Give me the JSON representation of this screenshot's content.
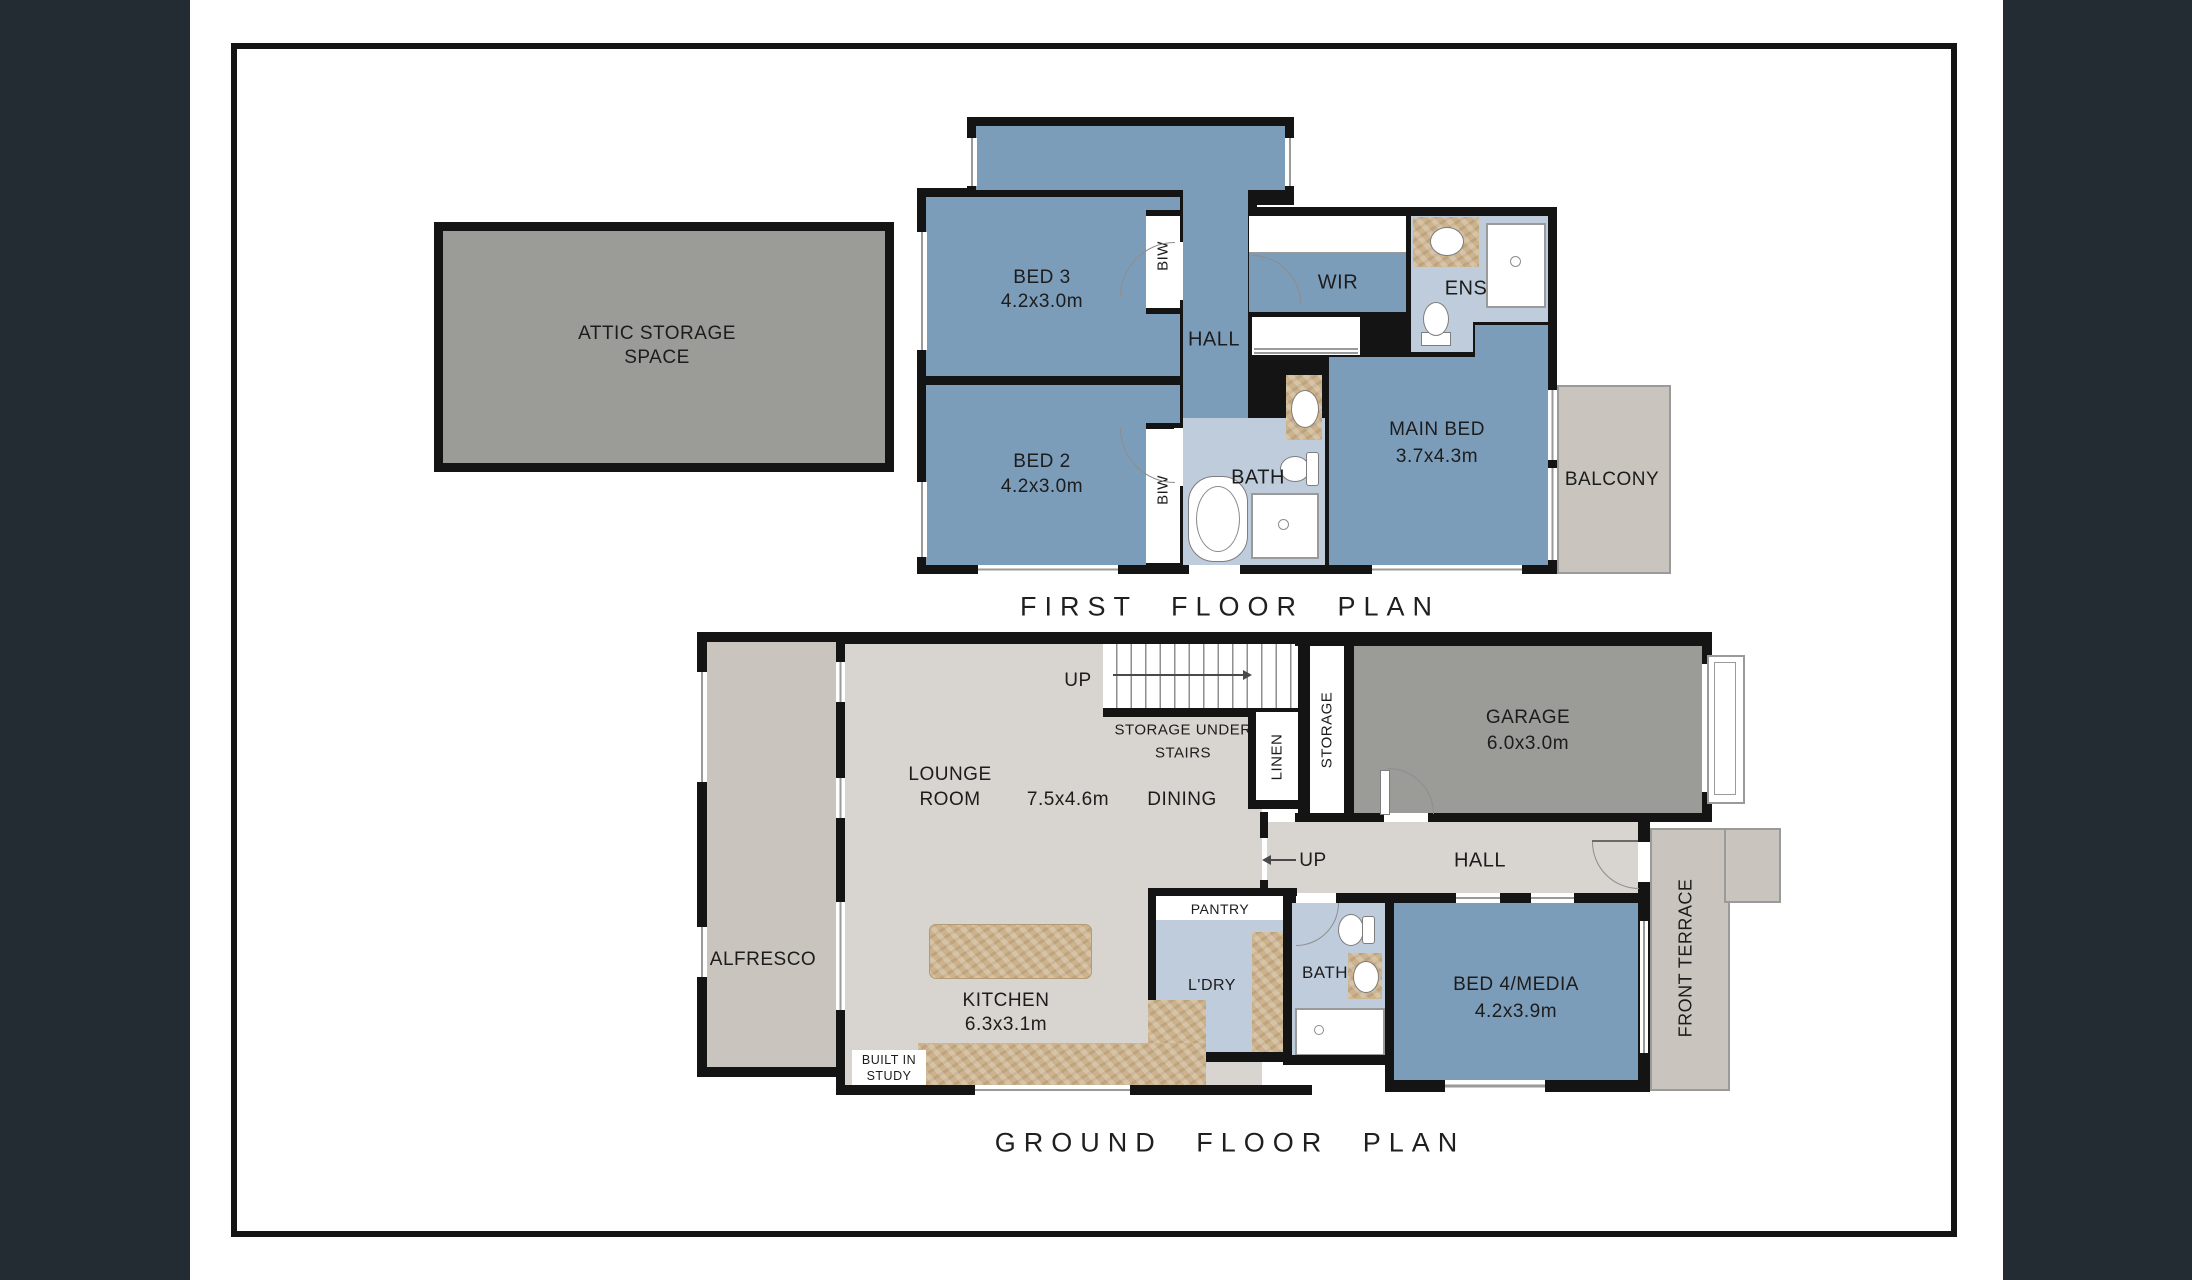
{
  "colors": {
    "page_background": "#232b33",
    "paper": "#ffffff",
    "wall": "#141414",
    "room_blue": "#7c9db9",
    "wet_area_blue": "#bfccdb",
    "floor_greige": "#d8d4cf",
    "outdoor_beige": "#c9c5be",
    "garage_gray": "#9b9b98",
    "counter_tan": "#ccb28d"
  },
  "first_floor": {
    "title": "FIRST FLOOR PLAN",
    "attic_label_line1": "ATTIC STORAGE",
    "attic_label_line2": "SPACE",
    "rooms": {
      "bed3_name": "BED 3",
      "bed3_dims": "4.2x3.0m",
      "bed2_name": "BED 2",
      "bed2_dims": "4.2x3.0m",
      "main_bed_name": "MAIN BED",
      "main_bed_dims": "3.7x4.3m",
      "hall": "HALL",
      "wir": "WIR",
      "ens": "ENS",
      "bath": "BATH",
      "balcony": "BALCONY",
      "biw": "BIW"
    }
  },
  "ground_floor": {
    "title": "GROUND FLOOR PLAN",
    "rooms": {
      "lounge_line1": "LOUNGE",
      "lounge_line2": "ROOM",
      "lounge_dims": "7.5x4.6m",
      "dining": "DINING",
      "kitchen_name": "KITCHEN",
      "kitchen_dims": "6.3x3.1m",
      "alfresco": "ALFRESCO",
      "garage_name": "GARAGE",
      "garage_dims": "6.0x3.0m",
      "hall": "HALL",
      "up_stairs": "UP",
      "up_hall": "UP",
      "storage_under_line1": "STORAGE UNDER",
      "storage_under_line2": "STAIRS",
      "linen": "LINEN",
      "storage": "STORAGE",
      "pantry": "PANTRY",
      "laundry": "L'DRY",
      "bath": "BATH",
      "bed4_name": "BED 4/MEDIA",
      "bed4_dims": "4.2x3.9m",
      "front_terrace": "FRONT TERRACE",
      "study_line1": "BUILT IN",
      "study_line2": "STUDY"
    }
  }
}
